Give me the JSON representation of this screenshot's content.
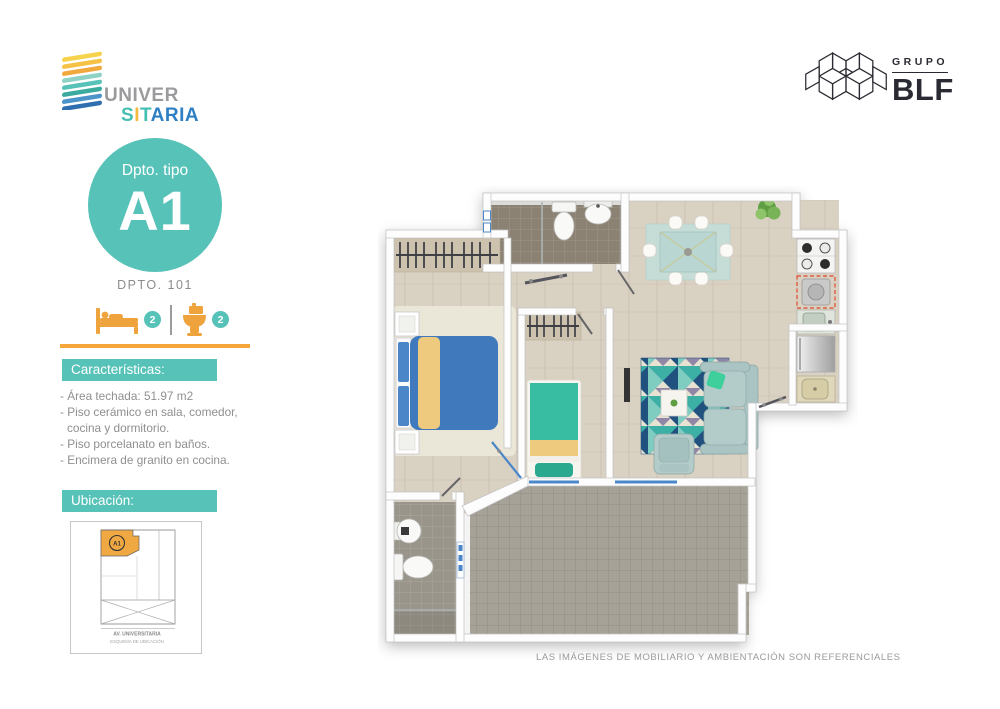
{
  "brand": {
    "line1": "UNIVER",
    "line2_letters": [
      "S",
      "I",
      "T",
      "A",
      "R",
      "I",
      "A"
    ]
  },
  "partner": {
    "group_label": "GRUPO",
    "name": "BLF"
  },
  "unit_badge": {
    "type_label": "Dpto. tipo",
    "type_code": "A1",
    "unit_number": "DPTO. 101"
  },
  "amenities": {
    "bedrooms": "2",
    "bathrooms": "2"
  },
  "features": {
    "title": "Características:",
    "items": [
      "- Área techada: 51.97 m2",
      "- Piso cerámico en sala, comedor, cocina y dormitorio.",
      "- Piso porcelanato en baños.",
      "- Encimera de granito en cocina."
    ]
  },
  "location": {
    "title": "Ubicación:",
    "unit_label": "A1",
    "street": "AV. UNIVERSITARIA",
    "caption": "ESQUEMA DE UBICACIÓN"
  },
  "disclaimer": "LAS IMÁGENES DE MOBILIARIO Y AMBIENTACIÓN SON REFERENCIALES",
  "colors": {
    "accent_teal": "#57c2b8",
    "accent_orange": "#f5a73b",
    "logo_yellow": "#f6b93f",
    "logo_blue": "#2e7fc4",
    "text_gray": "#8f8f8f",
    "logo_dark": "#2a2a32"
  }
}
